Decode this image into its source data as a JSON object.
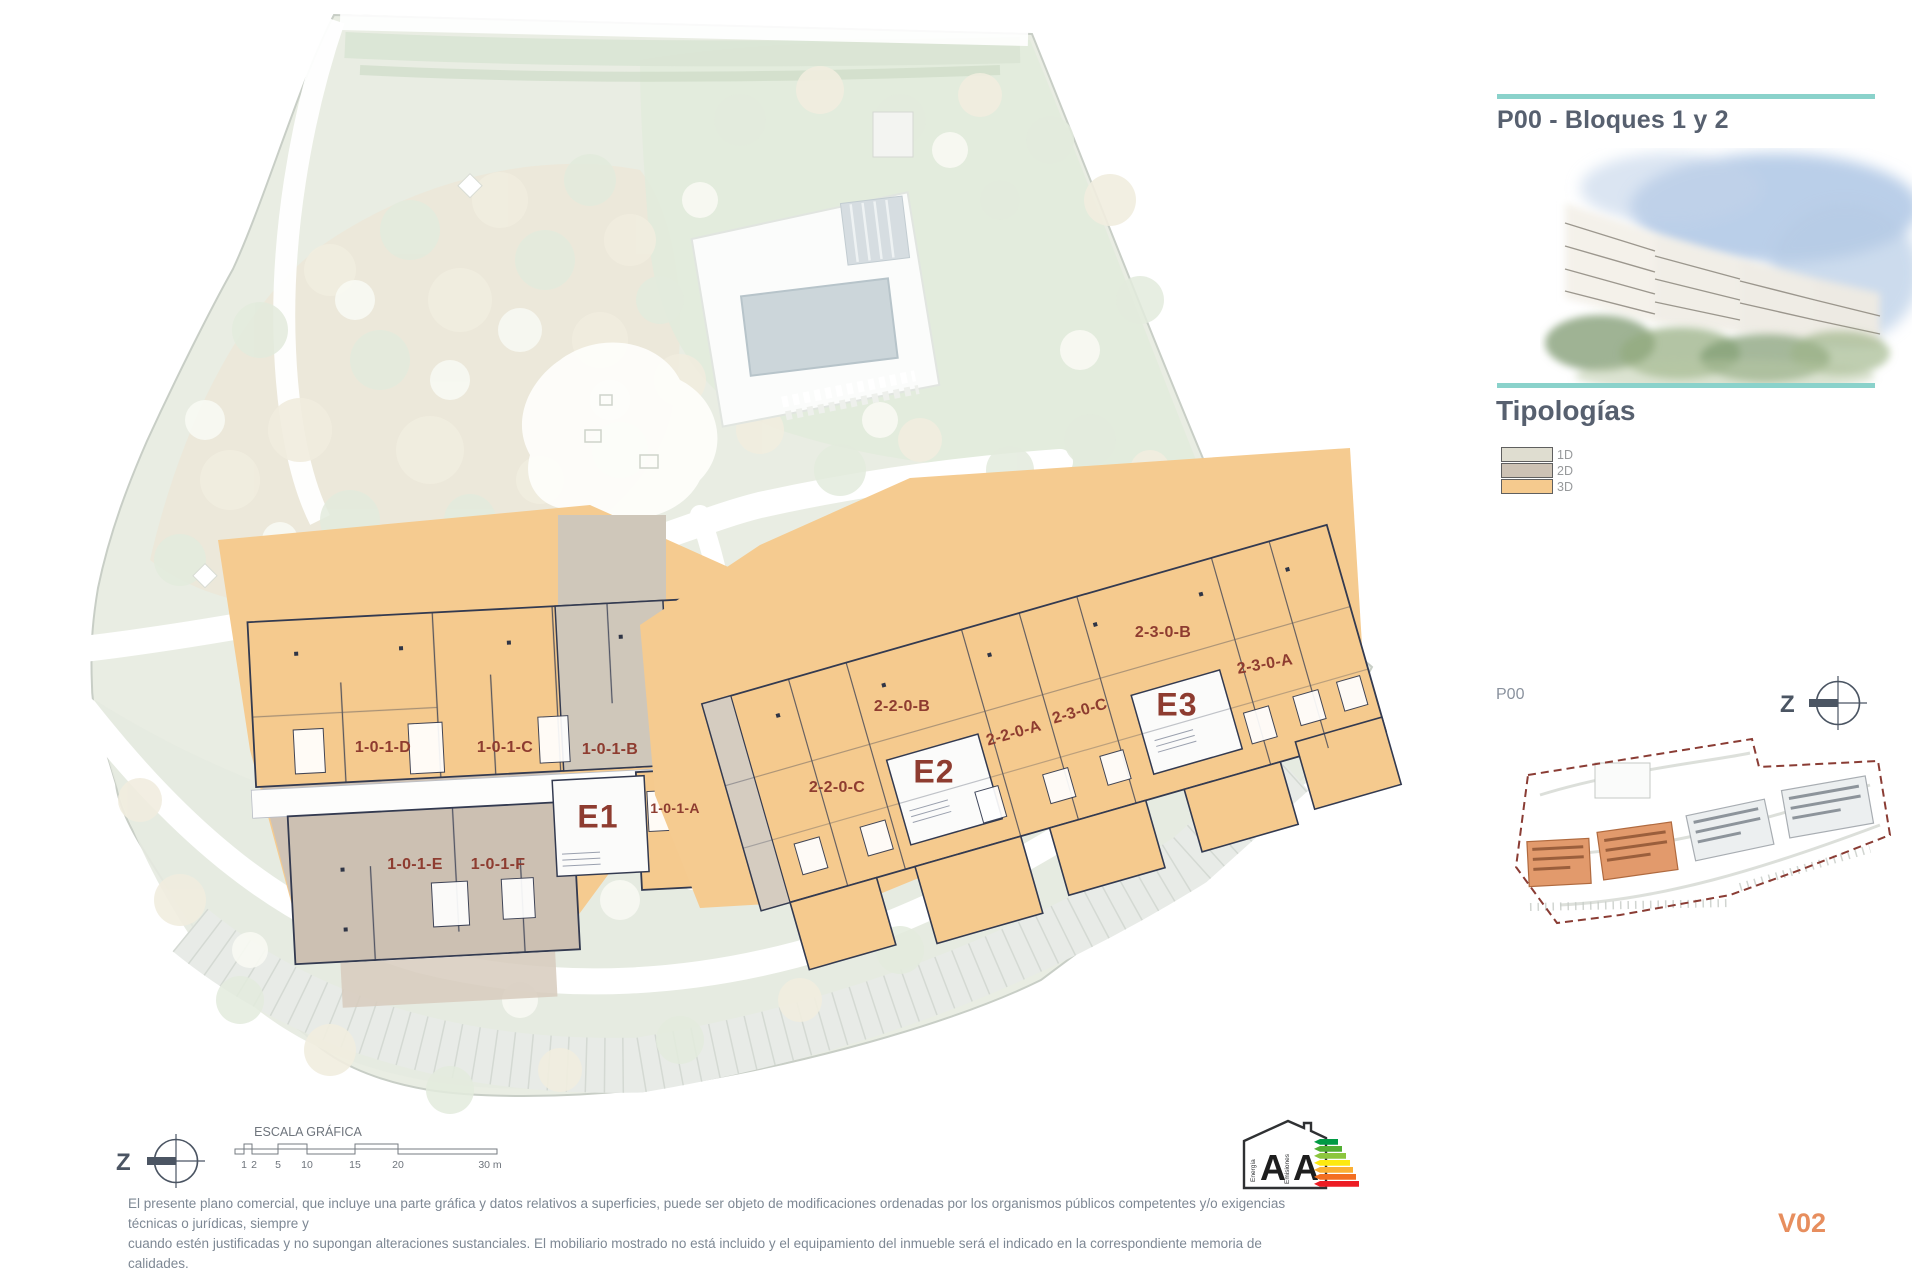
{
  "header": {
    "title": "P00 - Bloques 1 y 2",
    "typologies_title": "Tipologías",
    "accent_color": "#8ad2cb",
    "title_color": "#57606f"
  },
  "legend": {
    "items": [
      {
        "label": "1D",
        "color": "#dfddd0"
      },
      {
        "label": "2D",
        "color": "#cdc2b4"
      },
      {
        "label": "3D",
        "color": "#f5ca8e"
      }
    ]
  },
  "plan": {
    "label_color": "#8e3c30",
    "wall_color": "#333a50",
    "entrances": [
      {
        "text": "E1"
      },
      {
        "text": "E2"
      },
      {
        "text": "E3"
      }
    ],
    "units": [
      {
        "text": "1-0-1-D"
      },
      {
        "text": "1-0-1-C"
      },
      {
        "text": "1-0-1-B"
      },
      {
        "text": "1-0-1-A"
      },
      {
        "text": "1-0-1-E"
      },
      {
        "text": "1-0-1-F"
      },
      {
        "text": "2-2-0-C"
      },
      {
        "text": "2-2-0-B"
      },
      {
        "text": "2-2-0-A"
      },
      {
        "text": "2-3-0-C"
      },
      {
        "text": "2-3-0-B"
      },
      {
        "text": "2-3-0-A"
      }
    ]
  },
  "minimap": {
    "label": "P00",
    "compass_letter": "Z",
    "boundary_color": "#8a3c34",
    "highlight_color": "#e29a6c"
  },
  "scalebar": {
    "title": "ESCALA GRÁFICA",
    "compass_letter": "Z",
    "ticks": [
      {
        "label": "1"
      },
      {
        "label": "2"
      },
      {
        "label": "5"
      },
      {
        "label": "10"
      },
      {
        "label": "15"
      },
      {
        "label": "20"
      },
      {
        "label": "30 m"
      }
    ]
  },
  "footer": {
    "disclaimer_line1": "El presente plano comercial, que incluye una parte gráfica y datos relativos a superficies, puede ser objeto de modificaciones ordenadas por los organismos públicos competentes y/o exigencias técnicas o jurídicas, siempre y",
    "disclaimer_line2": "cuando estén justificadas y no supongan alteraciones sustanciales. El mobiliario mostrado no está incluido y el equipamiento del inmueble será el indicado en la correspondiente memoria de calidades.",
    "version": "V02",
    "version_color": "#e78e5e"
  },
  "energy_label": {
    "letters": [
      "A",
      "A"
    ],
    "axis_words": [
      "Energía",
      "Emisiones"
    ],
    "scale_colors": [
      "#009a44",
      "#52ae32",
      "#8cc63e",
      "#fde910",
      "#fbb034",
      "#f36f21",
      "#ed1c24"
    ]
  }
}
